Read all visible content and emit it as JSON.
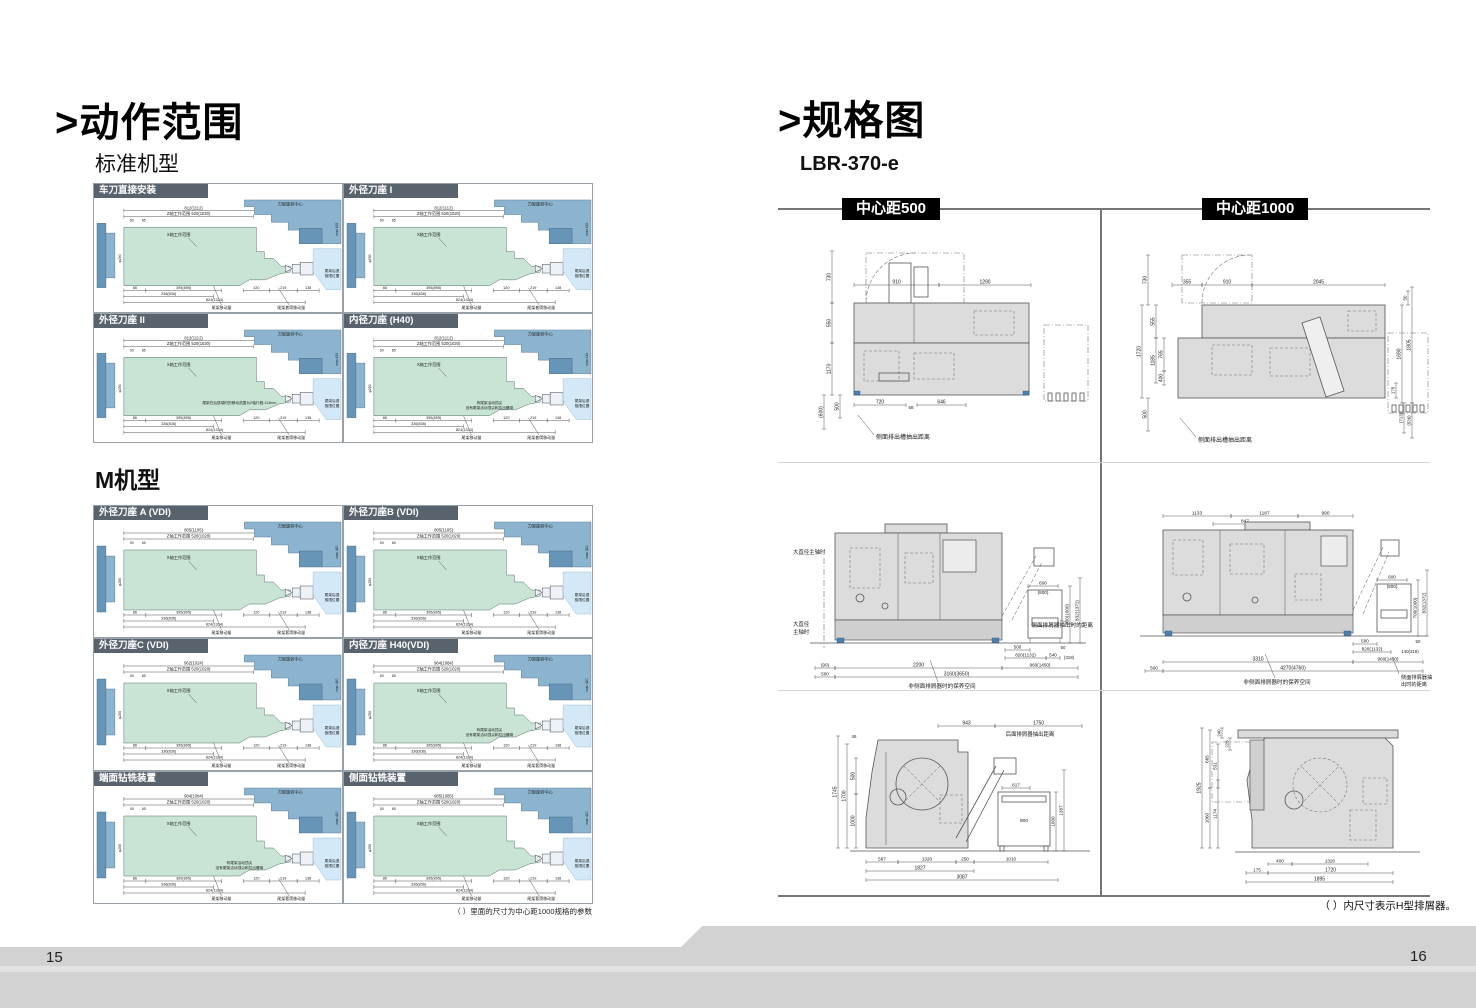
{
  "chrome": {
    "page_left_number": "15",
    "page_right_number": "16"
  },
  "left_page": {
    "title": ">动作范围",
    "sections": [
      {
        "heading": "标准机型",
        "panels": [
          {
            "title": "车刀直接安装",
            "top_dim": "812(1112)"
          },
          {
            "title": "外径刀座 I",
            "top_dim": "812(1112)"
          },
          {
            "title": "外径刀座 II",
            "top_dim": "812(1112)",
            "notes": [
              "尾架在后退端时的移动范围为Z轴行程-113mm"
            ]
          },
          {
            "title": "内径刀座 (H40)",
            "top_dim": "812(1112)",
            "notes": [
              "有尾架活动顶尖",
              "没有尾架活动顶尖和拉出螺母"
            ]
          }
        ]
      },
      {
        "heading": "M机型",
        "panels": [
          {
            "title": "外径刀座 A (VDI)",
            "top_dim": "805(1105)"
          },
          {
            "title": "外径刀座B (VDI)",
            "top_dim": "805(1105)"
          },
          {
            "title": "外径刀座C (VDI)",
            "top_dim": "962(1024)"
          },
          {
            "title": "内径刀座 H40(VDI)",
            "top_dim": "984(1084)",
            "notes": [
              "有尾架活动顶尖",
              "没有尾架活动顶尖和拉出螺母"
            ]
          },
          {
            "title": "端面钻铣装置",
            "top_dim": "984(1084)",
            "notes": [
              "有尾架活动顶尖",
              "没有尾架活动顶尖和拉出螺母"
            ]
          },
          {
            "title": "侧面钻铣装置",
            "top_dim": "985(1085)"
          }
        ]
      }
    ],
    "diagram_labels": {
      "turret_center": "刀架旋转中心",
      "z_range": "Z轴工作范围 520(1020)",
      "x_range": "X轴工作范围",
      "tail_limit1": "尾架后退",
      "tail_limit2": "极限位置",
      "tail_move": "尾架移动量",
      "quill_move": "尾架套筒移动量",
      "chuck": "φ250",
      "right_dim": "max 420",
      "small_dims": [
        "50",
        "85"
      ],
      "bottom_dims": [
        "86",
        "395(895)",
        "120",
        "219",
        "138"
      ],
      "totals": [
        "336(836)",
        "824(1324)"
      ]
    },
    "footnote": "（ ）里面的尺寸为中心距1000规格的参数"
  },
  "right_page": {
    "title": ">规格图",
    "model": "LBR-370-e",
    "columns": [
      {
        "badge": "中心距500"
      },
      {
        "badge": "中心距1000"
      }
    ],
    "footnote": "（ ）内尺寸表示H型排屑器。",
    "diagrams": [
      {
        "id": "plan500",
        "kind": "plan",
        "top": [
          "910",
          "1290"
        ],
        "left": [
          "730",
          "550",
          "1170",
          "(600)",
          "500"
        ],
        "bottom": [
          "720",
          "58",
          "646"
        ],
        "ann": "侧面排出槽抽出距离"
      },
      {
        "id": "plan1000",
        "kind": "plan",
        "top": [
          "355",
          "910",
          "2045"
        ],
        "left": [
          "730",
          "555",
          "1720",
          "1185",
          "765",
          "400",
          "500"
        ],
        "right": [
          "50",
          "1690",
          "1805",
          "175",
          "(713)",
          "(536)"
        ],
        "ann": "侧面排出槽抽出距离"
      },
      {
        "id": "front500",
        "kind": "front",
        "spindle_label": "大直径主轴时",
        "spindle_label2a": "大直径",
        "spindle_label2b": "主轴时",
        "right": [
          "600",
          "(800)",
          "700(1000)",
          "832(1372)"
        ],
        "mid": [
          "500",
          "820(1132)",
          "540",
          "(318)",
          "50"
        ],
        "bottom": [
          "(90)",
          "2200",
          "960(1450)",
          "500",
          "3160(3650)"
        ],
        "ann_side": "侧面排屑器抽出时的距离",
        "ann_space": "非侧面排屑器时的保养空间"
      },
      {
        "id": "front1000",
        "kind": "front",
        "top": [
          "1133",
          "1187",
          "990",
          "847"
        ],
        "right": [
          "600",
          "(800)",
          "700(1000)",
          "832(1372)"
        ],
        "mid": [
          "500",
          "820(1132)",
          "140(318)",
          "50"
        ],
        "bottom": [
          "3310",
          "960(1450)",
          "500",
          "4270(4760)"
        ],
        "ann_space": "非侧面排屑器时的保养空间",
        "ann_side_a": "侧面排屑器抽",
        "ann_side_b": "出时的距离"
      },
      {
        "id": "side500",
        "kind": "side",
        "top": [
          "943",
          "1750"
        ],
        "top_ann": "后面排屑器抽出距离",
        "left": [
          "45",
          "1745",
          "1700",
          "500",
          "1000"
        ],
        "right": [
          "817",
          "800",
          "1000",
          "1387"
        ],
        "bottom": [
          "567",
          "1320",
          "250",
          "1010",
          "1827",
          "3087"
        ]
      },
      {
        "id": "side1000",
        "kind": "side",
        "left": [
          "240",
          "225",
          "665",
          "531",
          "1925",
          "1060",
          "1174"
        ],
        "bottom": [
          "400",
          "1320",
          "175",
          "1720",
          "1895"
        ]
      }
    ]
  }
}
